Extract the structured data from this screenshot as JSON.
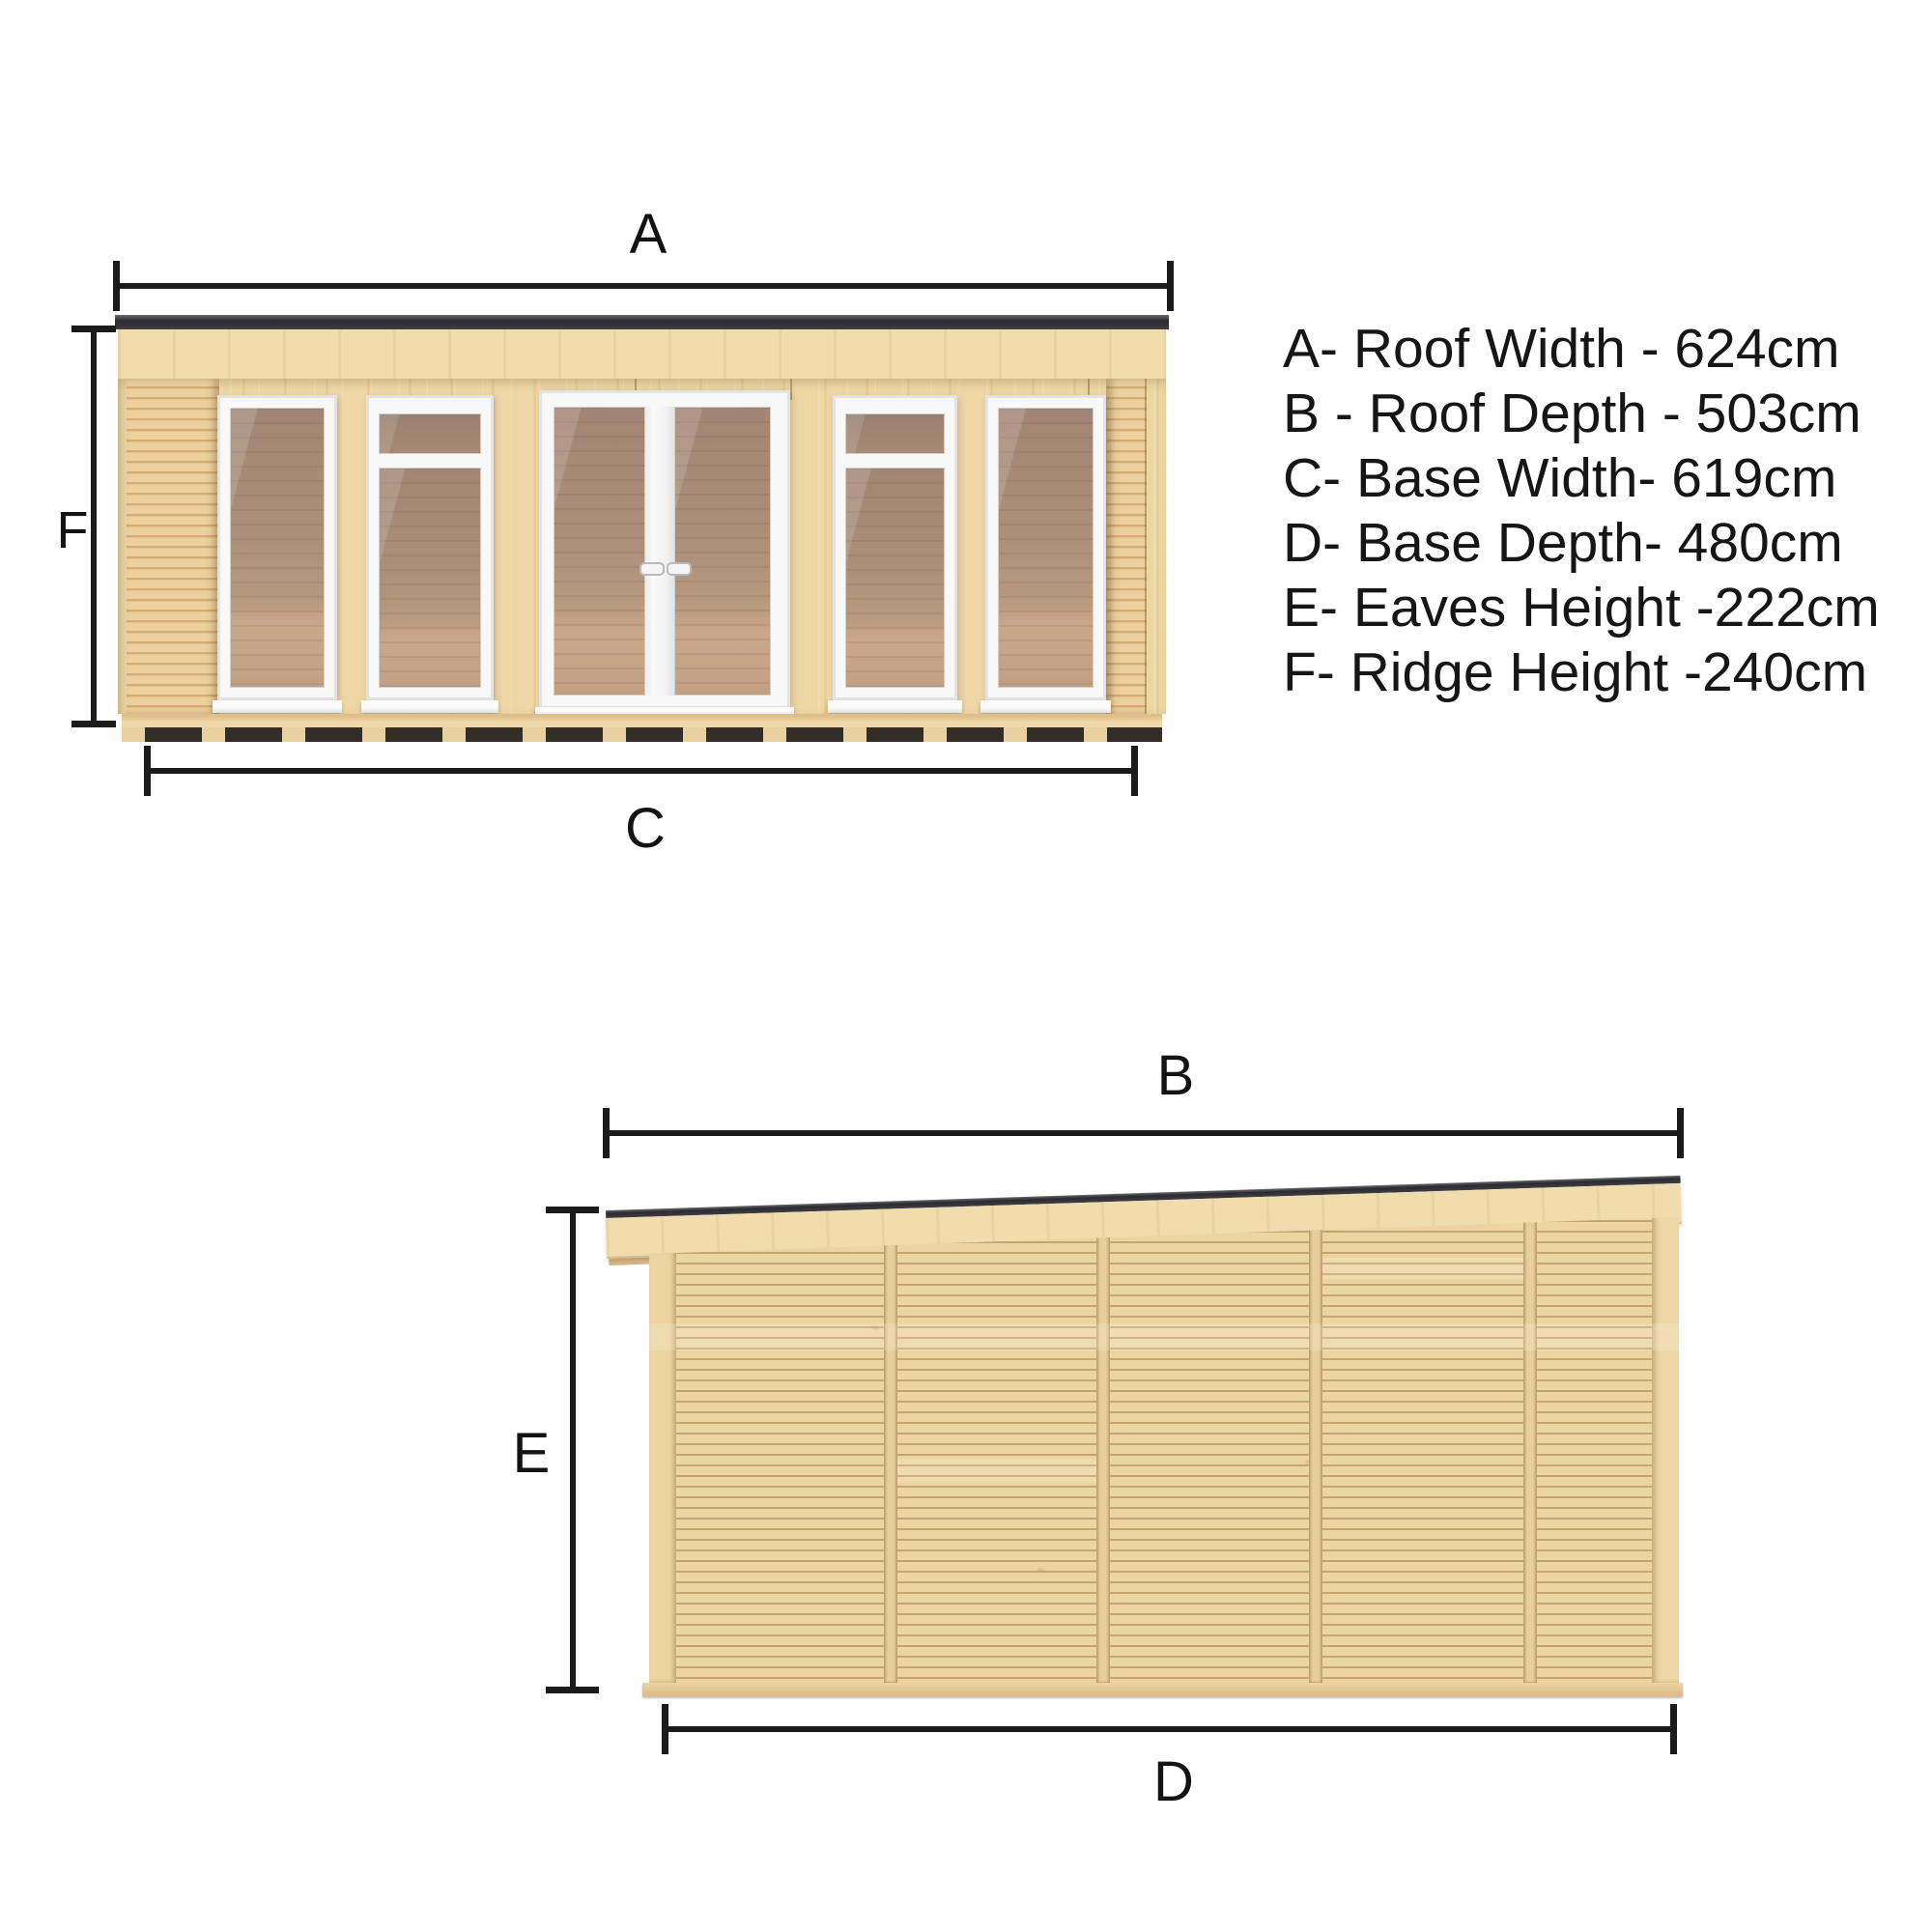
{
  "labels": {
    "roof_width": "A",
    "roof_depth": "B",
    "base_width": "C",
    "base_depth": "D",
    "eaves_height": "E",
    "ridge_height": "F"
  },
  "legend": {
    "items": [
      {
        "text": "A- Roof Width - 624cm"
      },
      {
        "text": "B - Roof Depth - 503cm"
      },
      {
        "text": "C- Base Width- 619cm"
      },
      {
        "text": "D- Base Depth- 480cm"
      },
      {
        "text": "E- Eaves Height -222cm"
      },
      {
        "text": "F- Ridge Height -240cm"
      }
    ]
  },
  "colors": {
    "roof_dark": "#2a2a2f",
    "wood_light": "#f1dcae",
    "wood_mid": "#eed6a5",
    "slat_shadow": "#d3ad74",
    "frame_white": "#f8f8f8",
    "glass_brown": "#ab8f7b",
    "bearer_gap": "#332e28",
    "dimension_line": "#1b1b1b",
    "background": "#ffffff"
  }
}
